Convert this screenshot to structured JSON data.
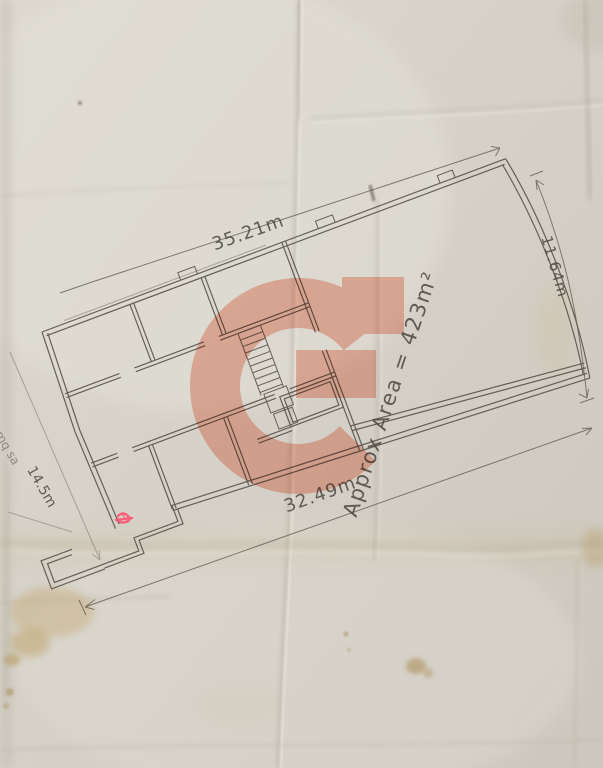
{
  "floor_plan": {
    "area_label": "Approx Area = 423m²",
    "dimensions": {
      "top": "35.21m",
      "bottom": "32.49m",
      "right": "11.64m",
      "left": "14.5m",
      "left_partial": "mq sa"
    },
    "colors": {
      "paper": "#d7d3ca",
      "pencil": "#4a463f",
      "watermark": "#f8b3a1",
      "red_mark": "#ff4d6e",
      "stain": "#b3945c"
    }
  }
}
